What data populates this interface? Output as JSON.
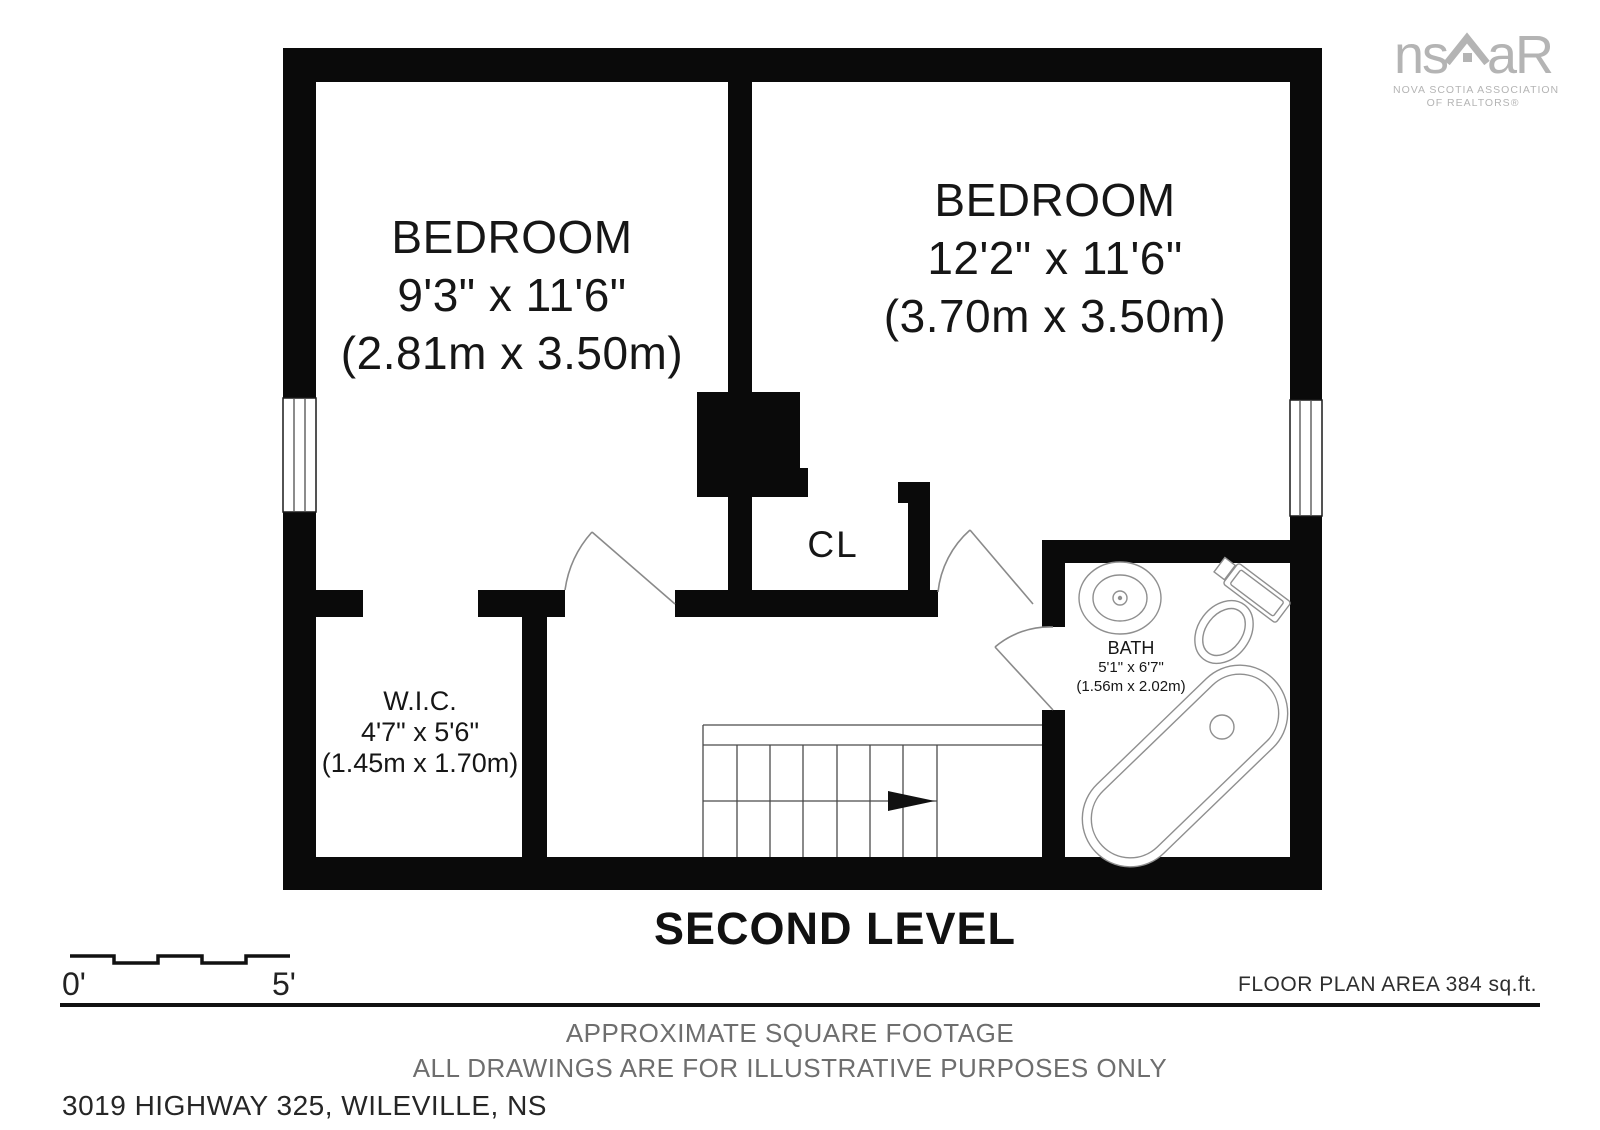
{
  "logo": {
    "mark_left": "ns",
    "mark_right": "aR",
    "caption_line1": "NOVA SCOTIA ASSOCIATION",
    "caption_line2": "OF REALTORS®"
  },
  "rooms": {
    "bedroom1": {
      "name": "BEDROOM",
      "dims_imperial": "9'3\" x 11'6\"",
      "dims_metric": "(2.81m x 3.50m)"
    },
    "bedroom2": {
      "name": "BEDROOM",
      "dims_imperial": "12'2\" x 11'6\"",
      "dims_metric": "(3.70m x 3.50m)"
    },
    "wic": {
      "name": "W.I.C.",
      "dims_imperial": "4'7\" x 5'6\"",
      "dims_metric": "(1.45m x 1.70m)"
    },
    "bath": {
      "name": "BATH",
      "dims_imperial": "5'1\" x 6'7\"",
      "dims_metric": "(1.56m x 2.02m)"
    },
    "closet": {
      "name": "CL"
    }
  },
  "footer": {
    "level_title": "SECOND LEVEL",
    "scale_start": "0'",
    "scale_end": "5'",
    "area_note": "FLOOR PLAN AREA 384 sq.ft.",
    "disclaimer_line1": "APPROXIMATE SQUARE FOOTAGE",
    "disclaimer_line2": "ALL DRAWINGS ARE FOR ILLUSTRATIVE PURPOSES ONLY",
    "address": "3019 HIGHWAY 325, WILEVILLE, NS"
  },
  "colors": {
    "wall": "#0a0a0a",
    "fixture_stroke": "#8f8f8f",
    "door_stroke": "#8a8a8a",
    "stair_stroke": "#4a4a4a",
    "logo_gray": "#b4b4b4",
    "muted_text": "#6e6e6e"
  }
}
